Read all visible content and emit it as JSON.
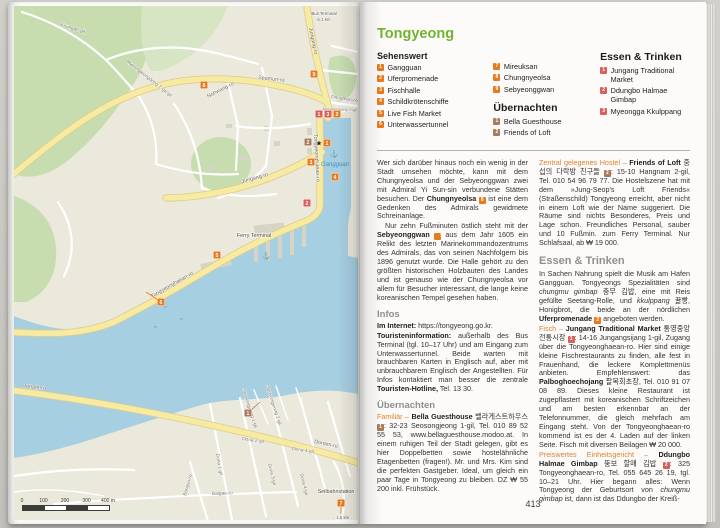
{
  "colors": {
    "green": "#72b32e",
    "orange": "#e0802f",
    "gray": "#8f8f8f",
    "sight": "#e87a1e",
    "hotel": "#ab7a5c",
    "food": "#d9605a"
  },
  "page_left": {
    "map": {
      "scalebar": {
        "labels": [
          "0",
          "100",
          "200",
          "300",
          "400 m"
        ]
      },
      "labels": [
        {
          "t": "Keungae-gil",
          "x": 46,
          "y": 20,
          "r": 16,
          "c": "road"
        },
        {
          "t": "Myeongjeongdong 2-ga-gil",
          "x": 112,
          "y": 56,
          "r": 38,
          "c": "road"
        },
        {
          "t": "Nohwang-ro",
          "x": 194,
          "y": 92,
          "r": -27,
          "c": "roadM"
        },
        {
          "t": "Seomun-ro",
          "x": 244,
          "y": 73,
          "r": 6,
          "c": "roadM"
        },
        {
          "t": "Jungang-ro",
          "x": 295,
          "y": 22,
          "r": 78,
          "c": "roadM"
        },
        {
          "t": "Dongmun-ro",
          "x": 317,
          "y": 92,
          "r": 9,
          "c": "road"
        },
        {
          "t": "Jungang-ro",
          "x": 228,
          "y": 177,
          "r": -15,
          "c": "roadM"
        },
        {
          "t": "Jungangsijang 1-gil",
          "x": 308,
          "y": 104,
          "r": 2,
          "c": "roadS"
        },
        {
          "t": "Tongyeonghaean-ro",
          "x": 138,
          "y": 292,
          "r": -30,
          "c": "roadM"
        },
        {
          "t": "Tongyeonghaean-ro",
          "x": 300,
          "y": 128,
          "r": 87,
          "c": "roadM"
        },
        {
          "t": "Donam-ro",
          "x": 8,
          "y": 381,
          "r": 7,
          "c": "roadM"
        },
        {
          "t": "Donam-ro",
          "x": 300,
          "y": 437,
          "r": 12,
          "c": "roadM"
        },
        {
          "t": "Balgae-ro",
          "x": 198,
          "y": 489,
          "r": -2,
          "c": "road"
        },
        {
          "t": "Bongsu-ro",
          "x": 172,
          "y": 490,
          "r": -74,
          "c": "road"
        },
        {
          "t": "Seosongjeong 1-gil",
          "x": 228,
          "y": 383,
          "r": 72,
          "c": "road"
        },
        {
          "t": "Seosongjeong 2-gil",
          "x": 252,
          "y": 380,
          "r": 72,
          "c": "road"
        },
        {
          "t": "Dona 1-gil",
          "x": 202,
          "y": 448,
          "r": 80,
          "c": "road"
        },
        {
          "t": "Dona 2-gil",
          "x": 228,
          "y": 434,
          "r": 8,
          "c": "road"
        },
        {
          "t": "Dona 3-gil",
          "x": 254,
          "y": 458,
          "r": 76,
          "c": "road"
        },
        {
          "t": "Dona 4-gil",
          "x": 278,
          "y": 444,
          "r": 8,
          "c": "road"
        },
        {
          "t": "Dona 4-gil",
          "x": 286,
          "y": 468,
          "r": 76,
          "c": "road"
        },
        {
          "t": "Ferry Terminal",
          "x": 240,
          "y": 231,
          "r": 0,
          "c": "place"
        },
        {
          "t": "Gangguan",
          "x": 321,
          "y": 160,
          "r": 0,
          "c": "water"
        },
        {
          "t": "Seilbahnstation",
          "x": 322,
          "y": 487,
          "r": 0,
          "c": "place"
        },
        {
          "t": "↓ 1,5 km",
          "x": 327,
          "y": 513,
          "r": 0,
          "c": "placeS"
        },
        {
          "t": "Bus Terminal",
          "x": 310,
          "y": 9,
          "r": 0,
          "c": "placeS"
        },
        {
          "t": "6,1 km",
          "x": 310,
          "y": 15,
          "r": 0,
          "c": "placeS"
        }
      ],
      "markers": [
        {
          "type": "sight",
          "n": "1",
          "x": 313,
          "y": 137,
          "star": true
        },
        {
          "type": "sight",
          "n": "2",
          "x": 323,
          "y": 108
        },
        {
          "type": "sight",
          "n": "3",
          "x": 297,
          "y": 156
        },
        {
          "type": "sight",
          "n": "4",
          "x": 321,
          "y": 171
        },
        {
          "type": "sight",
          "n": "5",
          "x": 203,
          "y": 249
        },
        {
          "type": "sight",
          "n": "6",
          "x": 147,
          "y": 296,
          "leader": [
            132,
            286
          ]
        },
        {
          "type": "sight",
          "n": "7",
          "x": 327,
          "y": 497,
          "leader": [
            327,
            508
          ]
        },
        {
          "type": "sight",
          "n": "8",
          "x": 190,
          "y": 79
        },
        {
          "type": "sight",
          "n": "9",
          "x": 300,
          "y": 68
        },
        {
          "type": "hotel",
          "n": "1",
          "x": 234,
          "y": 407,
          "leader": [
            246,
            396
          ]
        },
        {
          "type": "hotel",
          "n": "2",
          "x": 294,
          "y": 136
        },
        {
          "type": "food",
          "n": "1",
          "x": 305,
          "y": 108
        },
        {
          "type": "food",
          "n": "2",
          "x": 293,
          "y": 197
        },
        {
          "type": "food",
          "n": "3",
          "x": 314,
          "y": 108
        }
      ],
      "anchors": [
        {
          "x": 320,
          "y": 150
        },
        {
          "x": 252,
          "y": 252
        }
      ]
    }
  },
  "page_right": {
    "title": "Tongyeong",
    "page_number": "413",
    "legend": {
      "sehenswert": {
        "heading": "Sehenswert",
        "items": [
          {
            "n": "1",
            "label": "Gangguan"
          },
          {
            "n": "2",
            "label": "Uferpromenade"
          },
          {
            "n": "3",
            "label": "Fischhalle"
          },
          {
            "n": "4",
            "label": "Schildkrötenschiffe"
          },
          {
            "n": "5",
            "label": "Live Fish Market"
          },
          {
            "n": "6",
            "label": "Unterwassertunnel"
          },
          {
            "n": "7",
            "label": "Mireuksan"
          },
          {
            "n": "8",
            "label": "Chungnyeolsa"
          },
          {
            "n": "9",
            "label": "Sebyeonggwan"
          }
        ]
      },
      "uebernachten": {
        "heading": "Übernachten",
        "items": [
          {
            "n": "1",
            "label": "Bella Guesthouse"
          },
          {
            "n": "2",
            "label": "Friends of Loft"
          }
        ]
      },
      "essen": {
        "heading": "Essen & Trinken",
        "items": [
          {
            "n": "1",
            "label": "Jungang Traditional Market"
          },
          {
            "n": "2",
            "label": "Ddungbo Halmae Gimbap"
          },
          {
            "n": "3",
            "label": "Myeongga Kkulppang"
          }
        ]
      }
    },
    "article": {
      "left": [
        {
          "type": "p",
          "runs": [
            {
              "t": "Wer sich darüber hinaus noch ein wenig in der Stadt umsehen möchte, kann mit dem Chungnyeolsa und der Sebyeonggwan zwei mit Admiral Yi Sun-sin verbundene Stätten besuchen. Der "
            },
            {
              "t": "Chungnyeolsa",
              "b": 1
            },
            {
              "t": " "
            },
            {
              "m": {
                "type": "sight",
                "n": "8"
              }
            },
            {
              "t": " ist eine dem Gedenken des Admirals gewidmete Schreinanlage."
            }
          ]
        },
        {
          "type": "p",
          "indent": true,
          "runs": [
            {
              "t": "Nur zehn Fußminuten östlich steht mit der "
            },
            {
              "t": "Sebyeonggwan",
              "b": 1
            },
            {
              "t": " "
            },
            {
              "m": {
                "type": "sight",
                "n": "9"
              }
            },
            {
              "t": " aus dem Jahr 1605 ein Relikt des letzten Marinekommandozentrums des Admirals, das von seinen Nachfolgern bis 1896 genutzt wurde. Die Halle gehört zu den größten historischen Holzbauten des Landes und ist genauso wie der Chungnyeolsa vor allem für Besucher interessant, die lange keine koreanischen Tempel gesehen haben."
            }
          ]
        },
        {
          "type": "h",
          "text": "Infos"
        },
        {
          "type": "p",
          "runs": [
            {
              "t": "Im Internet:",
              "b": 1
            },
            {
              "t": " https://tongyeong.go.kr."
            }
          ]
        },
        {
          "type": "p",
          "runs": [
            {
              "t": "Touristeninformation:",
              "b": 1
            },
            {
              "t": " außerhalb des Bus Terminal (tgl. 10–17 Uhr) und am Eingang zum Unterwassertunnel. Beide warten mit brauchbaren Karten in Englisch auf, aber mit unbrauchbarem Englisch der Angestellten. Für Infos kontaktiert man besser die zentrale "
            },
            {
              "t": "Touristen-Hotline,",
              "b": 1
            },
            {
              "t": " Tel. 13 30."
            }
          ]
        },
        {
          "type": "h",
          "text": "Übernachten"
        },
        {
          "type": "p",
          "runs": [
            {
              "t": "Familiär – ",
              "c": "orange"
            },
            {
              "t": "Bella Guesthouse",
              "b": 1
            },
            {
              "t": " 벨라게스트하우스 "
            },
            {
              "m": {
                "type": "hotel",
                "n": "1"
              }
            },
            {
              "t": ": 32-23 Seosongjeong 1-gil, Tel. 010 89 52 55 53, www.bellaguesthouse.modoo.at. In einem ruhigen Teil der Stadt gelegen, gibt es hier Doppelbetten sowie hostelähnliche Etagenbetten (fragen!). Mr. und Mrs. Kim sind die perfekten Gastgeber. Ideal, um gleich ein paar Tage in Tongyeong zu bleiben. DZ ₩ 55 200 inkl. Frühstück."
            }
          ]
        }
      ],
      "right": [
        {
          "type": "p",
          "runs": [
            {
              "t": "Zentral gelegenes Hostel – ",
              "c": "orange"
            },
            {
              "t": "Friends of Loft",
              "b": 1
            },
            {
              "t": " 중섭의 다락방 친구들 "
            },
            {
              "m": {
                "type": "hotel",
                "n": "2"
              }
            },
            {
              "t": ": 15-10 Hangnam 2-gil, Tel. 010 54 96 79 77. Die Hostelszene hat mit dem »Jung-Seop's Loft Friends« (Straßenschild) Tongyeong erreicht, aber nicht in einem Loft wie der Name suggeriert. Die Räume sind nichts Besonderes, Preis und Lage schon. Freundliches Personal, sauber und 10 Fußmin. zum Ferry Terminal. Nur Schlafsaal, ab ₩ 19 000."
            }
          ]
        },
        {
          "type": "h2",
          "text": "Essen & Trinken"
        },
        {
          "type": "p",
          "runs": [
            {
              "t": "In Sachen Nahrung spielt die Musik am Hafen Gangguan. Tongyeongs Spezialitäten sind "
            },
            {
              "t": "chungmu gimbap",
              "i": 1
            },
            {
              "t": " 충무 김밥, eine mit Reis gefüllte Seetang-Rolle, und "
            },
            {
              "t": "kkulppang",
              "i": 1
            },
            {
              "t": " 꿀빵, Honigbrot, die beide an der nördlichen "
            },
            {
              "t": "Uferpromenade",
              "b": 1
            },
            {
              "t": " "
            },
            {
              "m": {
                "type": "sight",
                "n": "2"
              }
            },
            {
              "t": " angeboten werden."
            }
          ]
        },
        {
          "type": "p",
          "runs": [
            {
              "t": "Fisch – ",
              "c": "orange"
            },
            {
              "t": "Jungang Traditional Market",
              "b": 1
            },
            {
              "t": " 통영중앙전통시장 "
            },
            {
              "m": {
                "type": "food",
                "n": "1"
              }
            },
            {
              "t": ": 14-16 Jungangsijang 1-gil, Zugang über die Tongyeonghaean-ro. Hier sind einige kleine Fischrestaurants zu finden, alle fest in Frauenhand, die leckere Komplettmenüs anbieten. Empfehlenswert: das "
            },
            {
              "t": "Palboghoechojang",
              "b": 1
            },
            {
              "t": " 팔복회초장, Tel. 010 91 07 08 89. Dieses kleine Restaurant ist zugepflastert mit koreanischen Schriftzeichen und am besten erkennbar an der Telefonnummer, die gleich mehrfach am Eingang steht. Von der Tongyeonghaean-ro kommend ist es der 4. Laden auf der linken Seite. Fisch mit diversen Beilagen ₩ 20 000."
            }
          ]
        },
        {
          "type": "p",
          "runs": [
            {
              "t": "Preiswertes Einheitsgericht – ",
              "c": "orange"
            },
            {
              "t": "Ddungbo Halmae Gimbap",
              "b": 1
            },
            {
              "t": " 뚱보 할매 김밥 "
            },
            {
              "m": {
                "type": "food",
                "n": "2"
              }
            },
            {
              "t": ": 325 Tongyeonghaean-ro, Tel. 055 645 26 19, tgl. 10–21 Uhr. Hier begann alles: Wenn Tongyeong der Geburtsort von "
            },
            {
              "t": "chungmu gimbap",
              "i": 1
            },
            {
              "t": " ist, dann ist das Ddungbo der Kreiß-"
            }
          ]
        }
      ]
    }
  }
}
